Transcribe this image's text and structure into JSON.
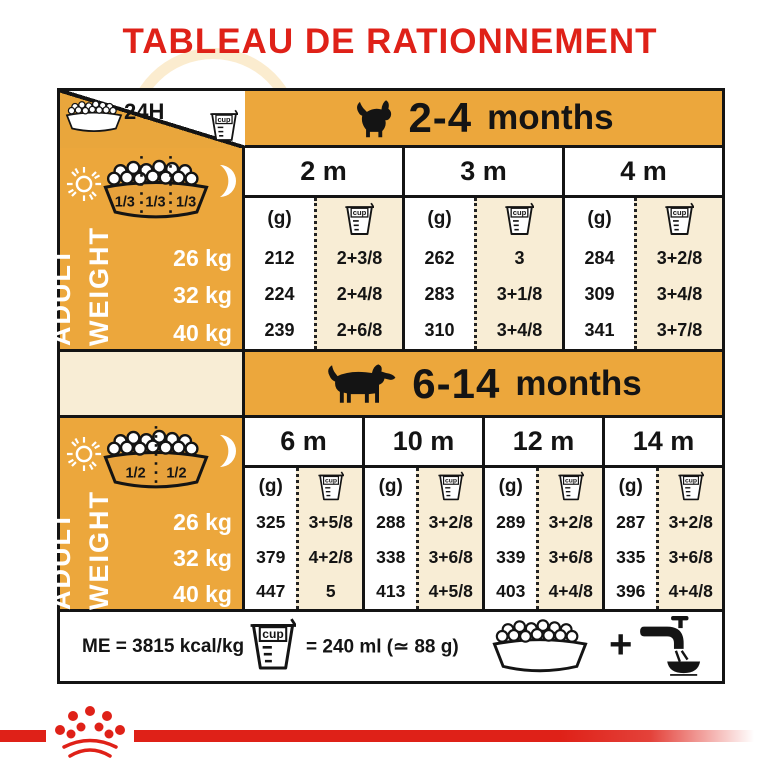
{
  "title": "TABLEAU DE RATIONNEMENT",
  "colors": {
    "red": "#DF2118",
    "gold": "#ECA73C",
    "cream": "#F8EDD5",
    "line": "#141414"
  },
  "legend": {
    "duration": "24H",
    "cup_label": "cup"
  },
  "labels": {
    "g": "(g)",
    "adult": "ADULT",
    "weight": "WEIGHT",
    "plus": "+"
  },
  "section1": {
    "age_number": "2-4",
    "age_word": "months",
    "fractions": [
      "1/3",
      "1/3",
      "1/3"
    ]
  },
  "section2": {
    "age_number": "6-14",
    "age_word": "months",
    "fractions": [
      "1/2",
      "1/2"
    ]
  },
  "footer": {
    "energy": "ME = 3815 kcal/kg",
    "cup_equiv": "= 240 ml (≃ 88 g)"
  },
  "icons": {
    "food_bowl": "kibble-bowl",
    "measuring_cup": "cup-beaker",
    "sun": "sun-rays",
    "moon": "crescent-moon",
    "puppy": "puppy-silhouette",
    "adult_dog": "dog-silhouette",
    "water_tap": "faucet-pouring-into-bowl",
    "brand": "royal-canin-crown"
  },
  "chart_data": [
    {
      "type": "table",
      "age_range": "2-4 months",
      "months": [
        "2 m",
        "3 m",
        "4 m"
      ],
      "unit_headers": [
        "(g)",
        "cup"
      ],
      "weight_rows": [
        "26 kg",
        "32 kg",
        "40 kg"
      ],
      "values": [
        [
          "212",
          "2+3/8",
          "262",
          "3",
          "284",
          "3+2/8"
        ],
        [
          "224",
          "2+4/8",
          "283",
          "3+1/8",
          "309",
          "3+4/8"
        ],
        [
          "239",
          "2+6/8",
          "310",
          "3+4/8",
          "341",
          "3+7/8"
        ]
      ]
    },
    {
      "type": "table",
      "age_range": "6-14 months",
      "months": [
        "6 m",
        "10 m",
        "12 m",
        "14 m"
      ],
      "unit_headers": [
        "(g)",
        "cup"
      ],
      "weight_rows": [
        "26 kg",
        "32 kg",
        "40 kg"
      ],
      "values": [
        [
          "325",
          "3+5/8",
          "288",
          "3+2/8",
          "289",
          "3+2/8",
          "287",
          "3+2/8"
        ],
        [
          "379",
          "4+2/8",
          "338",
          "3+6/8",
          "339",
          "3+6/8",
          "335",
          "3+6/8"
        ],
        [
          "447",
          "5",
          "413",
          "4+5/8",
          "403",
          "4+4/8",
          "396",
          "4+4/8"
        ]
      ]
    }
  ]
}
